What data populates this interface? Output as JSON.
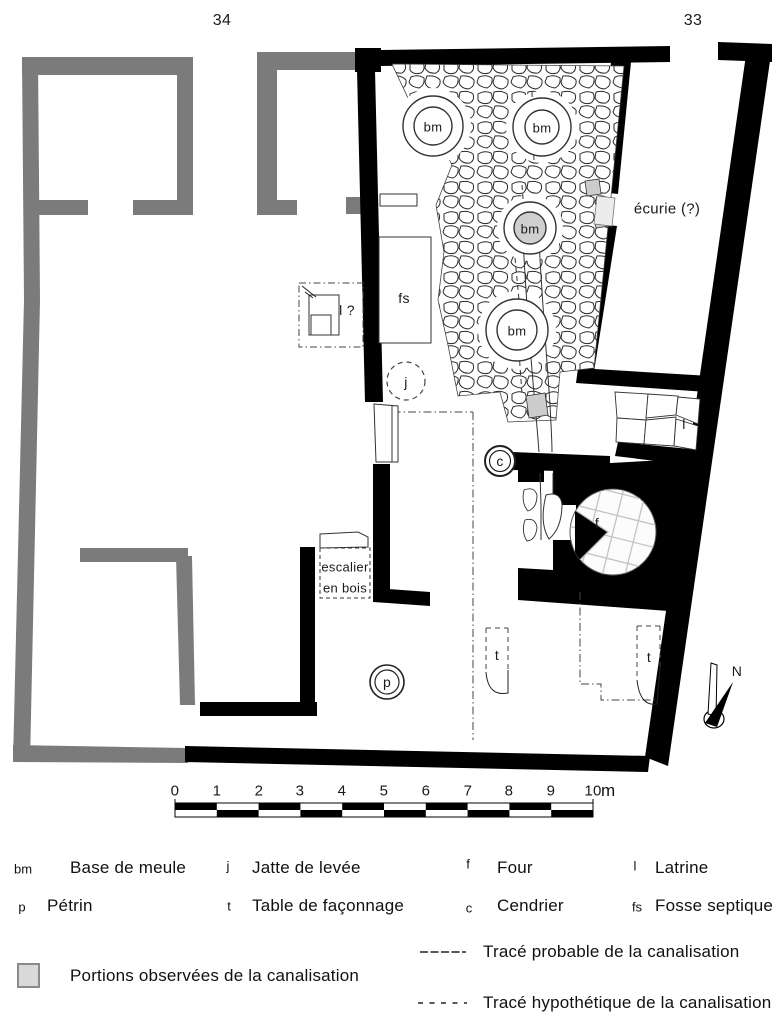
{
  "plan": {
    "street_numbers": {
      "left": "34",
      "right": "33"
    },
    "marks": {
      "bm": "bm",
      "p": "p",
      "j": "j",
      "t": "t",
      "f": "f",
      "c": "c",
      "l": "l",
      "fs": "fs",
      "l_unknown": "l ?"
    },
    "room_labels": {
      "ecurie": "écurie (?)",
      "stairs_line1": "escalier",
      "stairs_line2": "en bois"
    },
    "north_label": "N"
  },
  "scalebar": {
    "ticks": [
      "0",
      "1",
      "2",
      "3",
      "4",
      "5",
      "6",
      "7",
      "8",
      "9",
      "10"
    ],
    "unit": "m"
  },
  "legend": {
    "items": [
      {
        "symbol": "bm",
        "label": "Base de meule"
      },
      {
        "symbol": "j",
        "label": "Jatte de levée"
      },
      {
        "symbol": "f",
        "label": "Four"
      },
      {
        "symbol": "l",
        "label": "Latrine"
      },
      {
        "symbol": "p",
        "label": "Pétrin"
      },
      {
        "symbol": "t",
        "label": "Table de façonnage"
      },
      {
        "symbol": "c",
        "label": "Cendrier"
      },
      {
        "symbol": "fs",
        "label": "Fosse septique"
      }
    ],
    "observed": "Portions observées de la canalisation",
    "probable": "Tracé probable de la canalisation",
    "hypothetical": "Tracé hypothétique de la canalisation"
  },
  "colors": {
    "wall_black": "#000000",
    "wall_gray": "#7b7b7b",
    "canal_observed_gray": "#cccccc",
    "legend_square_fill": "#d9d9d9",
    "stone_stroke": "#2a2a2a"
  }
}
